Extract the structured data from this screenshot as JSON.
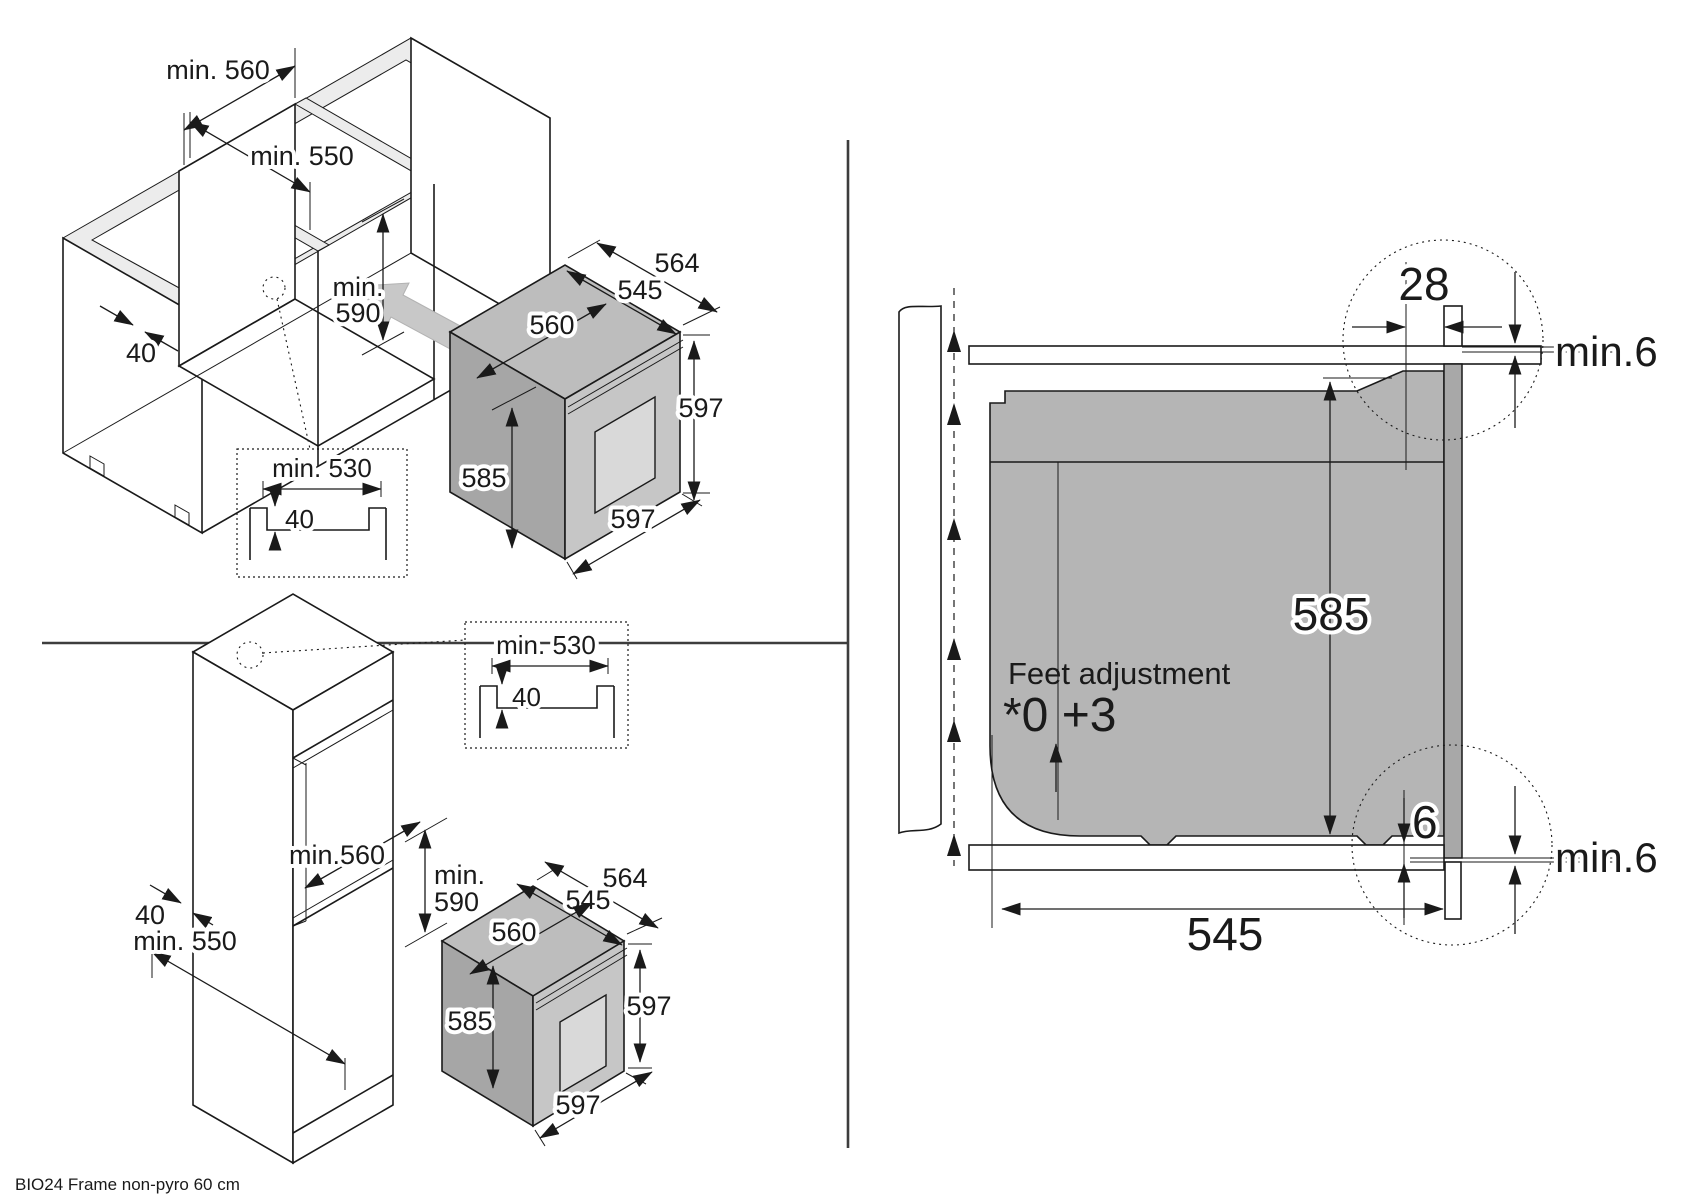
{
  "footer_note": "BIO24 Frame non-pyro 60 cm",
  "colors": {
    "line": "#1a1a1a",
    "oven_body_gray": "#b5b5b5",
    "oven_side_gray": "#a6a6a6",
    "oven_front_gray": "#c6c6c6",
    "window_gray": "#d9d9d9",
    "insert_arrow_gray": "#c8c8c8",
    "trim_gray": "#a8a8a8"
  },
  "base_view": {
    "niche_width": "min. 560",
    "niche_depth": "min. 550",
    "niche_height_line1": "min.",
    "niche_height_line2": "590",
    "rail_width": "40",
    "inset": {
      "width": "min. 530",
      "depth": "40"
    },
    "oven": {
      "depth_overall": "564",
      "depth_body": "545",
      "width_body": "560",
      "height_body": "585",
      "height_front": "597",
      "width_front": "597"
    }
  },
  "tall_view": {
    "niche_height_line1": "min.",
    "niche_height_line2": "590",
    "niche_width": "min.560",
    "rail_width": "40",
    "niche_depth": "min. 550",
    "inset": {
      "width": "min. 530",
      "depth": "40"
    },
    "oven": {
      "depth_overall": "564",
      "depth_body": "545",
      "width_body": "560",
      "height_body": "585",
      "height_front": "597",
      "width_front": "597"
    }
  },
  "section_view": {
    "top_rail_depth": "28",
    "top_clearance": "min.6",
    "oven_height": "585",
    "feet_title": "Feet adjustment",
    "feet_range": "*0 +3",
    "bottom_offset": "6",
    "bottom_clearance": "min.6",
    "body_depth": "545"
  }
}
